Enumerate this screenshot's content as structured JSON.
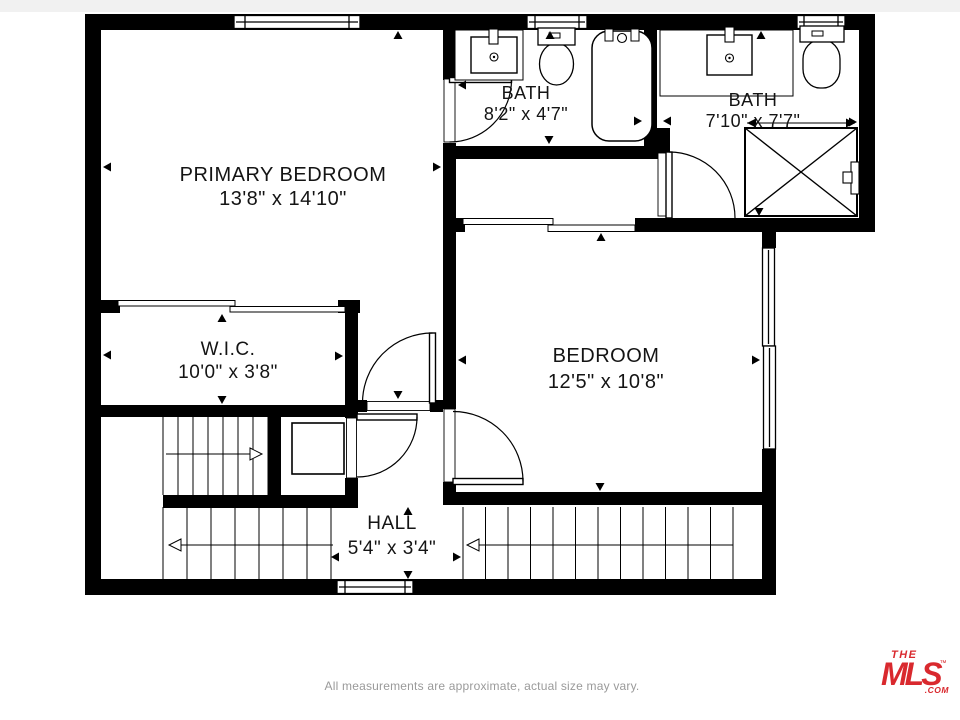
{
  "rooms": [
    {
      "id": "primary-bedroom",
      "name": "PRIMARY BEDROOM",
      "dims": "13'8\" x 14'10\""
    },
    {
      "id": "bath-1",
      "name": "BATH",
      "dims": "8'2\" x 4'7\""
    },
    {
      "id": "bath-2",
      "name": "BATH",
      "dims": "7'10\" x 7'7\""
    },
    {
      "id": "wic",
      "name": "W.I.C.",
      "dims": "10'0\" x 3'8\""
    },
    {
      "id": "bedroom",
      "name": "BEDROOM",
      "dims": "12'5\" x 10'8\""
    },
    {
      "id": "hall",
      "name": "HALL",
      "dims": "5'4\" x 3'4\""
    }
  ],
  "fixtures": [
    "sink",
    "toilet",
    "bathtub",
    "shower",
    "sliding-closet-doors",
    "staircase",
    "door",
    "window"
  ],
  "footer": {
    "disclaimer": "All measurements are approximate, actual size may vary."
  },
  "logo": {
    "line1": "THE",
    "line2": "MLS",
    "tm": "™",
    "com": ".COM"
  },
  "colors": {
    "walls": "#000000",
    "background": "#ffffff",
    "logo_red": "#d9292e",
    "footer_gray": "#9a9a9a"
  }
}
